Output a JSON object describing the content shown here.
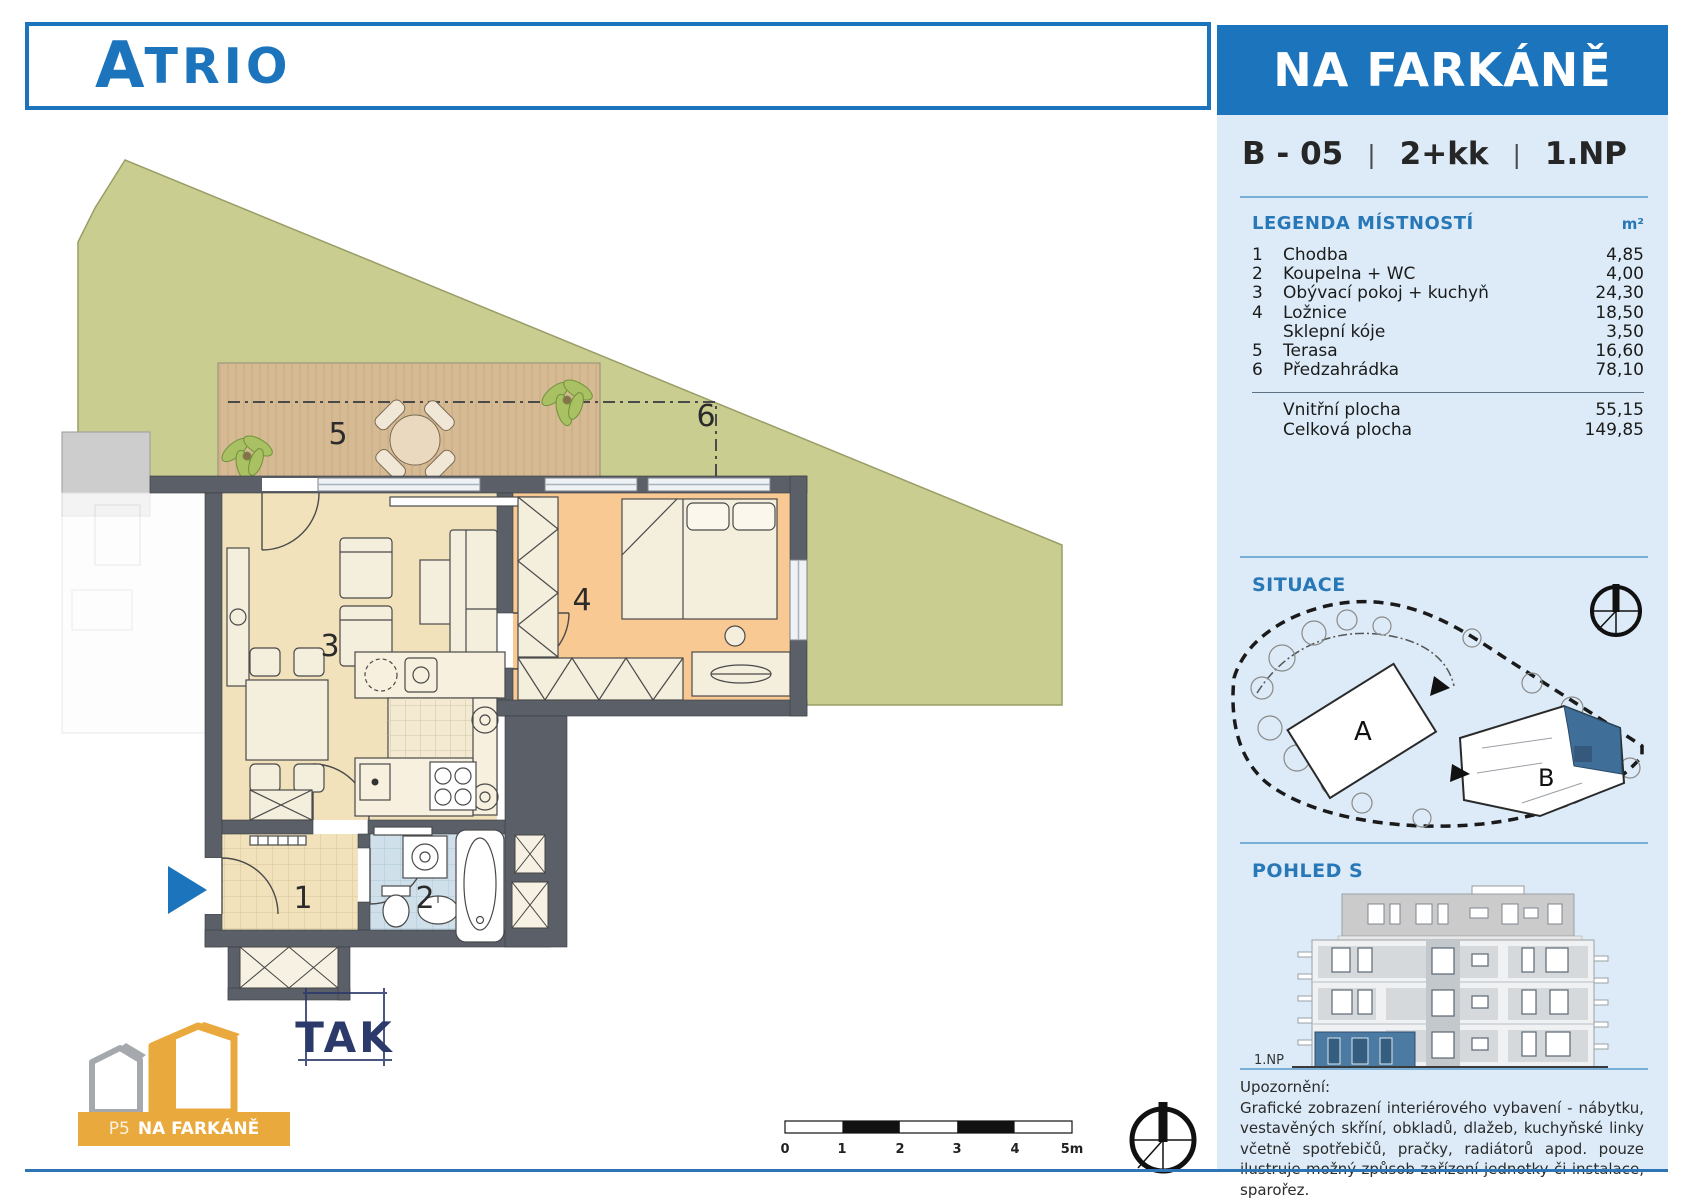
{
  "header": {
    "brand_initial": "A",
    "brand_rest": "TRIO",
    "project": "NA FARKÁNĚ"
  },
  "unit": {
    "id": "B - 05",
    "sep": "|",
    "layout": "2+kk",
    "floor": "1.NP"
  },
  "legend": {
    "title": "LEGENDA MÍSTNOSTÍ",
    "unit_header": "m²",
    "rooms": [
      {
        "no": "1",
        "name": "Chodba",
        "area": "4,85"
      },
      {
        "no": "2",
        "name": "Koupelna + WC",
        "area": "4,00"
      },
      {
        "no": "3",
        "name": "Obývací pokoj + kuchyň",
        "area": "24,30"
      },
      {
        "no": "4",
        "name": "Ložnice",
        "area": "18,50"
      },
      {
        "no": "",
        "name": "Sklepní kóje",
        "area": "3,50"
      },
      {
        "no": "5",
        "name": "Terasa",
        "area": "16,60"
      },
      {
        "no": "6",
        "name": "Předzahrádka",
        "area": "78,10"
      }
    ],
    "totals": [
      {
        "name": "Vnitřní plocha",
        "area": "55,15"
      },
      {
        "name": "Celková plocha",
        "area": "149,85"
      }
    ]
  },
  "situace": {
    "title": "SITUACE",
    "building_a": "A",
    "building_b": "B"
  },
  "pohled": {
    "title": "POHLED S",
    "floor_label": "1.NP"
  },
  "notice": {
    "title": "Upozornění:",
    "body": "Grafické zobrazení interiérového vybavení - nábytku, vestavěných skříní, obkladů, dlažeb, kuchyňské linky včetně spotřebičů, pračky, radiátorů apod. pouze ilustruje možný způsob zařízení jednotky či instalace, sparořez."
  },
  "plan": {
    "numbers": {
      "hall": "1",
      "bath": "2",
      "living": "3",
      "bedroom": "4",
      "terrace": "5",
      "garden": "6"
    }
  },
  "scalebar": {
    "labels": [
      "0",
      "1",
      "2",
      "3",
      "4",
      "5m"
    ]
  },
  "footer": {
    "p5_prefix": "P5",
    "p5_name": "NA FARKÁNĚ",
    "tak": "TAK"
  },
  "colors": {
    "brand": "#1c75bc",
    "panelbg": "#dcebf7",
    "wall": "#5b6068",
    "garden": "#c9cd90",
    "terrace": "#d6ba93",
    "living": "#f1e2bc",
    "bedroom": "#f8c992",
    "bath": "#cfe0ea",
    "highlight": "#3f6f99",
    "orange": "#e9a93d"
  }
}
